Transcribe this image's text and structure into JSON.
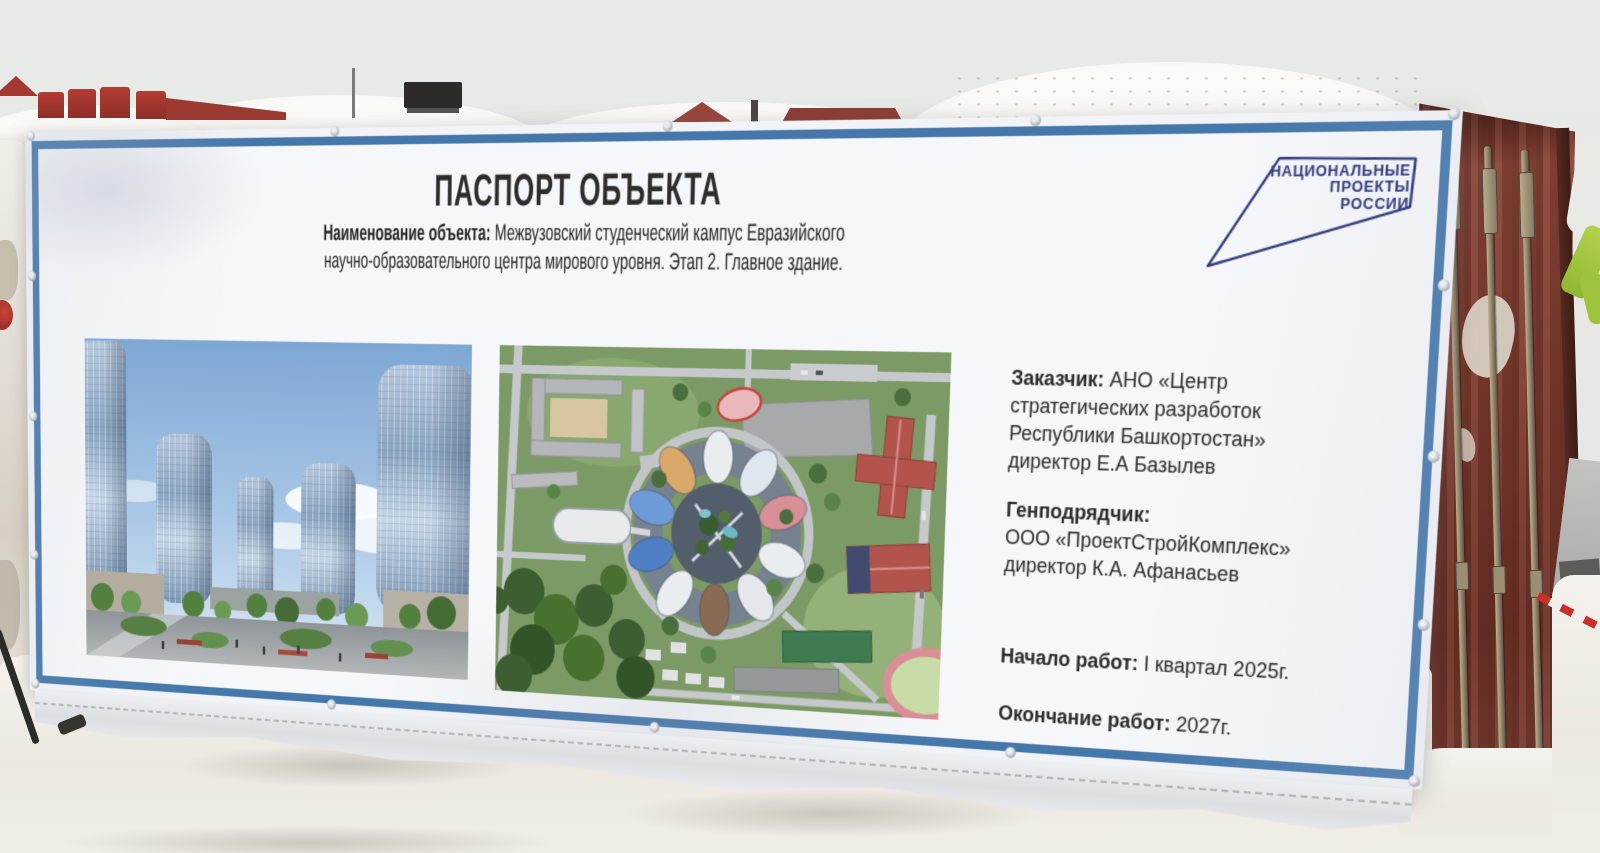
{
  "banner": {
    "title": "ПАСПОРТ ОБЪЕКТА",
    "name_label": "Наименование объекта:",
    "name_rest": " Межвузовский студенческий кампус Евразийского",
    "name_line2": "научно-образовательного центра мирового уровня. Этап 2. Главное здание.",
    "customer_label": "Заказчик:",
    "customer_rest": " АНО «Центр стратегических разработок Республики Башкортостан» директор Е.А Базылев",
    "contractor_label": "Генподрядчик:",
    "contractor_text": "ООО «ПроектСтройКомплекс» директор К.А. Афанасьев",
    "start_label": "Начало работ:",
    "start_rest": " I квартал 2025г.",
    "finish_label": "Окончание работ:",
    "finish_rest": " 2027г."
  },
  "logo": {
    "line1": "НАЦИОНАЛЬНЫЕ",
    "line2": "ПРОЕКТЫ",
    "line3": "РОССИИ"
  },
  "colors": {
    "border_blue": "#4577ab",
    "logo_navy": "#333a7d",
    "container_red": "#7d3b30",
    "banner_white": "#f6f7fa",
    "sky_gray": "#e7e9e7"
  }
}
